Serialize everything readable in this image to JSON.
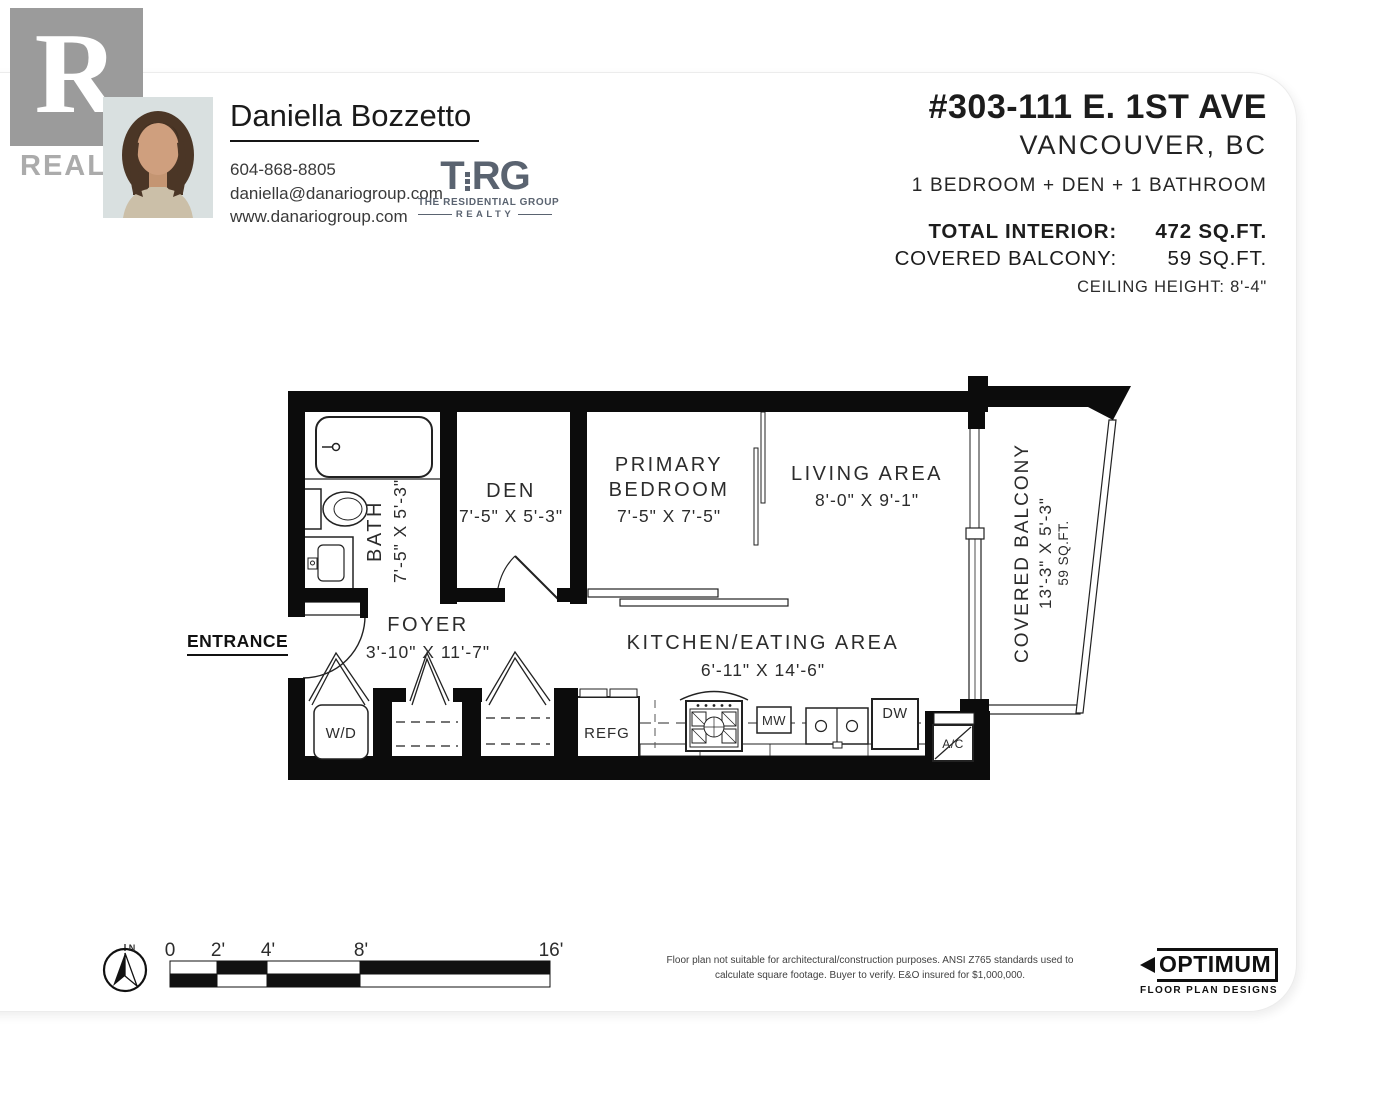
{
  "branding": {
    "realtor_letter": "R",
    "realtor_word": "REALTOR",
    "trg_t": "T",
    "trg_rg": "RG",
    "trg_line1": "THE RESIDENTIAL GROUP",
    "trg_line2": "REALTY"
  },
  "agent": {
    "name": "Daniella Bozzetto",
    "phone": "604-868-8805",
    "email": "daniella@danariogroup.com",
    "website": "www.danariogroup.com"
  },
  "listing": {
    "address_line1": "#303-111 E. 1ST AVE",
    "address_line2": "VANCOUVER, BC",
    "summary": "1 BEDROOM + DEN + 1 BATHROOM",
    "total_interior_label": "TOTAL INTERIOR:",
    "total_interior_value": "472 SQ.FT.",
    "balcony_label": "COVERED BALCONY:",
    "balcony_value": "59 SQ.FT.",
    "ceiling": "CEILING HEIGHT: 8'-4\""
  },
  "floorplan": {
    "entrance_label": "ENTRANCE",
    "rooms": {
      "bath": {
        "name": "BATH",
        "dims": "7'-5\" X 5'-3\""
      },
      "den": {
        "name": "DEN",
        "dims": "7'-5\" X 5'-3\""
      },
      "primary": {
        "name1": "PRIMARY",
        "name2": "BEDROOM",
        "dims": "7'-5\" X 7'-5\""
      },
      "living": {
        "name": "LIVING AREA",
        "dims": "8'-0\" X 9'-1\""
      },
      "balcony": {
        "name": "COVERED BALCONY",
        "dims": "13'-3\" X 5'-3\"",
        "area": "59 SQ.FT."
      },
      "foyer": {
        "name": "FOYER",
        "dims": "3'-10\" X 11'-7\""
      },
      "kitchen": {
        "name": "KITCHEN/EATING AREA",
        "dims": "6'-11\" X 14'-6\""
      }
    },
    "appliances": {
      "wd": "W/D",
      "refg": "REFG",
      "mw": "MW",
      "dw": "DW",
      "ac": "A/C"
    }
  },
  "scalebar": {
    "north": "N",
    "labels": [
      "0",
      "2'",
      "4'",
      "8'",
      "16'"
    ]
  },
  "footer": {
    "disclaimer1": "Floor plan not suitable for architectural/construction purposes. ANSI Z765 standards used to",
    "disclaimer2": "calculate square footage. Buyer to verify.  E&O insured for $1,000,000.",
    "optimum_name": "OPTIMUM",
    "optimum_sub": "FLOOR PLAN DESIGNS"
  },
  "colors": {
    "wall": "#0c0c0c",
    "trg_slate": "#5a6370",
    "realtor_gray": "#9b9b9b"
  }
}
